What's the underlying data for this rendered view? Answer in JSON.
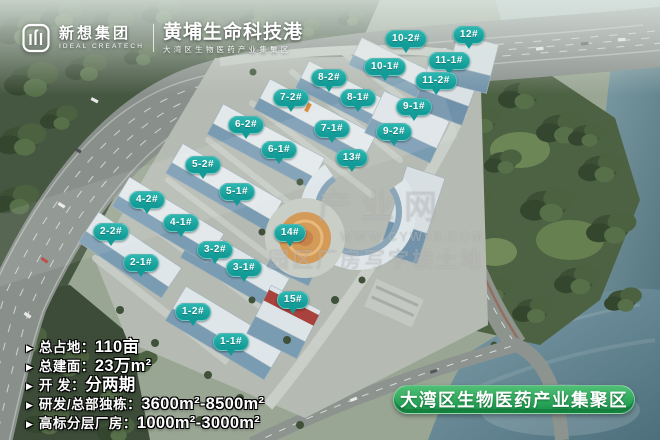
{
  "header": {
    "brand_cn": "新想集团",
    "brand_en": "IDEAL CREATECH",
    "park_title": "黄埔生命科技港",
    "park_subtitle": "大湾区生物医药产业集聚区"
  },
  "markers": {
    "items": [
      {
        "label": "1-1#",
        "x": 231,
        "y": 342
      },
      {
        "label": "1-2#",
        "x": 193,
        "y": 312
      },
      {
        "label": "2-1#",
        "x": 141,
        "y": 263
      },
      {
        "label": "2-2#",
        "x": 111,
        "y": 232
      },
      {
        "label": "3-1#",
        "x": 244,
        "y": 268
      },
      {
        "label": "3-2#",
        "x": 215,
        "y": 250
      },
      {
        "label": "4-1#",
        "x": 181,
        "y": 223
      },
      {
        "label": "4-2#",
        "x": 147,
        "y": 200
      },
      {
        "label": "5-1#",
        "x": 237,
        "y": 192
      },
      {
        "label": "5-2#",
        "x": 203,
        "y": 165
      },
      {
        "label": "6-1#",
        "x": 279,
        "y": 150
      },
      {
        "label": "6-2#",
        "x": 246,
        "y": 125
      },
      {
        "label": "7-1#",
        "x": 332,
        "y": 129
      },
      {
        "label": "7-2#",
        "x": 291,
        "y": 98
      },
      {
        "label": "8-1#",
        "x": 358,
        "y": 98
      },
      {
        "label": "8-2#",
        "x": 329,
        "y": 78
      },
      {
        "label": "9-1#",
        "x": 414,
        "y": 107
      },
      {
        "label": "9-2#",
        "x": 394,
        "y": 132
      },
      {
        "label": "10-1#",
        "x": 385,
        "y": 67
      },
      {
        "label": "10-2#",
        "x": 406,
        "y": 39
      },
      {
        "label": "11-1#",
        "x": 449,
        "y": 61
      },
      {
        "label": "11-2#",
        "x": 436,
        "y": 81
      },
      {
        "label": "12#",
        "x": 469,
        "y": 35
      },
      {
        "label": "13#",
        "x": 352,
        "y": 158
      },
      {
        "label": "14#",
        "x": 290,
        "y": 233
      },
      {
        "label": "15#",
        "x": 293,
        "y": 300
      }
    ]
  },
  "specs": {
    "items": [
      {
        "label": "总占地：",
        "value": "110亩"
      },
      {
        "label": "总建面：",
        "value": "23万m²"
      },
      {
        "label": "开  发：",
        "value": "分两期"
      },
      {
        "label": "研发/总部独栋：",
        "value": "3600m²-8500m²"
      },
      {
        "label": "高标分层厂房：",
        "value": "1000m²-3000m²"
      }
    ],
    "bullet_icon": "▶"
  },
  "banner": {
    "text": "大湾区生物医药产业集聚区"
  },
  "watermark": {
    "line1": "产业网",
    "line2": "WWW.CYW98.COM",
    "line3": "园区厂房写字楼土地"
  },
  "colors": {
    "marker_teal": "#139b97",
    "banner_green": "#1f9b50"
  }
}
